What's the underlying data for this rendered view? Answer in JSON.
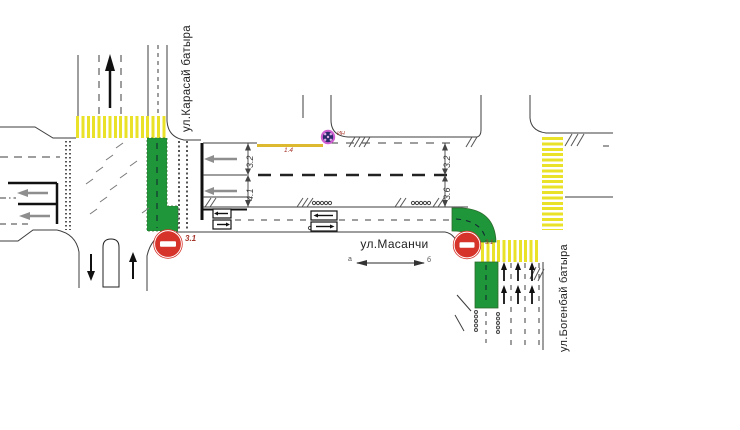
{
  "streets": {
    "karasai": "ул.Карасай батыра",
    "masanchi": "ул.Масанчи",
    "bogenbai": "ул.Богенбай батыра"
  },
  "dimensions": {
    "left_lane_top": "3.2",
    "left_lane_bottom": "4.1",
    "right_lane_top": "3.2",
    "right_lane_bottom": "3.6",
    "yellow_line_marking": "1.4"
  },
  "signs": {
    "no_entry_left": "3.1",
    "no_entry_right": "3.1",
    "hump_marker": "ИН"
  },
  "section_markers": {
    "start": "а",
    "end": "б"
  },
  "colors": {
    "crosswalk_yellow": "#e9e228",
    "bus_lane_green": "#1f9639",
    "no_entry_red": "#d6332a",
    "marking_yellow_line": "#ddb92f",
    "annotation_red": "#a6352b",
    "lane_arrow_gray": "#8e8e8e",
    "hump_icon_purple": "#cf5ed0"
  }
}
